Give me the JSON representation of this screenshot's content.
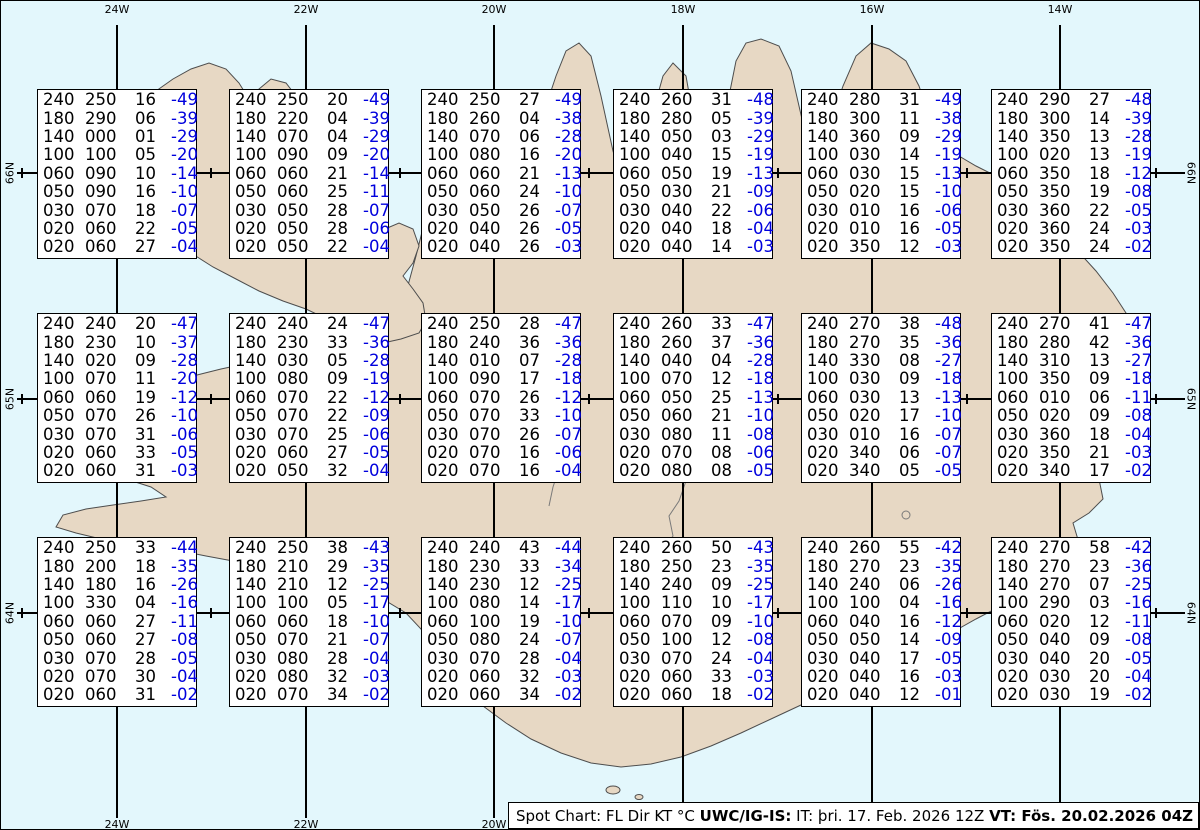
{
  "map": {
    "colors": {
      "water": "#e3f7fc",
      "land": "#e7d8c4",
      "coast": "#4d4d4d",
      "grid": "#000000",
      "temp_blue": "#0000dd"
    },
    "meridians": [
      {
        "label": "24W",
        "x": 116
      },
      {
        "label": "22W",
        "x": 305
      },
      {
        "label": "20W",
        "x": 493
      },
      {
        "label": "18W",
        "x": 682
      },
      {
        "label": "16W",
        "x": 871
      },
      {
        "label": "14W",
        "x": 1059
      }
    ],
    "parallels": [
      {
        "label": "66N",
        "y": 172
      },
      {
        "label": "65N",
        "y": 398
      },
      {
        "label": "64N",
        "y": 612
      }
    ]
  },
  "spots": {
    "legend_columns": [
      "FL",
      "Dir",
      "KT",
      "°C"
    ],
    "boxes": [
      {
        "lines": [
          [
            "240",
            "250",
            "16",
            "-49"
          ],
          [
            "180",
            "290",
            "06",
            "-39"
          ],
          [
            "140",
            "000",
            "01",
            "-29"
          ],
          [
            "100",
            "100",
            "05",
            "-20"
          ],
          [
            "060",
            "090",
            "10",
            "-14"
          ],
          [
            "050",
            "090",
            "16",
            "-10"
          ],
          [
            "030",
            "070",
            "18",
            "-07"
          ],
          [
            "020",
            "060",
            "22",
            "-05"
          ],
          [
            "020",
            "060",
            "27",
            "-04"
          ]
        ]
      },
      {
        "lines": [
          [
            "240",
            "250",
            "20",
            "-49"
          ],
          [
            "180",
            "220",
            "04",
            "-39"
          ],
          [
            "140",
            "070",
            "04",
            "-29"
          ],
          [
            "100",
            "090",
            "09",
            "-20"
          ],
          [
            "060",
            "060",
            "21",
            "-14"
          ],
          [
            "050",
            "060",
            "25",
            "-11"
          ],
          [
            "030",
            "050",
            "28",
            "-07"
          ],
          [
            "020",
            "050",
            "28",
            "-06"
          ],
          [
            "020",
            "050",
            "22",
            "-04"
          ]
        ]
      },
      {
        "lines": [
          [
            "240",
            "250",
            "27",
            "-49"
          ],
          [
            "180",
            "260",
            "04",
            "-38"
          ],
          [
            "140",
            "070",
            "06",
            "-28"
          ],
          [
            "100",
            "080",
            "16",
            "-20"
          ],
          [
            "060",
            "060",
            "21",
            "-13"
          ],
          [
            "050",
            "060",
            "24",
            "-10"
          ],
          [
            "030",
            "050",
            "26",
            "-07"
          ],
          [
            "020",
            "040",
            "26",
            "-05"
          ],
          [
            "020",
            "040",
            "26",
            "-03"
          ]
        ]
      },
      {
        "lines": [
          [
            "240",
            "260",
            "31",
            "-48"
          ],
          [
            "180",
            "280",
            "05",
            "-39"
          ],
          [
            "140",
            "050",
            "03",
            "-29"
          ],
          [
            "100",
            "040",
            "15",
            "-19"
          ],
          [
            "060",
            "050",
            "19",
            "-13"
          ],
          [
            "050",
            "030",
            "21",
            "-09"
          ],
          [
            "030",
            "040",
            "22",
            "-06"
          ],
          [
            "020",
            "040",
            "18",
            "-04"
          ],
          [
            "020",
            "040",
            "14",
            "-03"
          ]
        ]
      },
      {
        "lines": [
          [
            "240",
            "280",
            "31",
            "-49"
          ],
          [
            "180",
            "300",
            "11",
            "-38"
          ],
          [
            "140",
            "360",
            "09",
            "-29"
          ],
          [
            "100",
            "030",
            "14",
            "-19"
          ],
          [
            "060",
            "030",
            "15",
            "-13"
          ],
          [
            "050",
            "020",
            "15",
            "-10"
          ],
          [
            "030",
            "010",
            "16",
            "-06"
          ],
          [
            "020",
            "010",
            "16",
            "-05"
          ],
          [
            "020",
            "350",
            "12",
            "-03"
          ]
        ]
      },
      {
        "lines": [
          [
            "240",
            "290",
            "27",
            "-48"
          ],
          [
            "180",
            "300",
            "14",
            "-39"
          ],
          [
            "140",
            "350",
            "13",
            "-28"
          ],
          [
            "100",
            "020",
            "13",
            "-19"
          ],
          [
            "060",
            "350",
            "18",
            "-12"
          ],
          [
            "050",
            "350",
            "19",
            "-08"
          ],
          [
            "030",
            "360",
            "22",
            "-05"
          ],
          [
            "020",
            "360",
            "24",
            "-03"
          ],
          [
            "020",
            "350",
            "24",
            "-02"
          ]
        ]
      },
      {
        "lines": [
          [
            "240",
            "240",
            "20",
            "-47"
          ],
          [
            "180",
            "230",
            "10",
            "-37"
          ],
          [
            "140",
            "020",
            "09",
            "-28"
          ],
          [
            "100",
            "070",
            "11",
            "-20"
          ],
          [
            "060",
            "060",
            "19",
            "-12"
          ],
          [
            "050",
            "070",
            "26",
            "-10"
          ],
          [
            "030",
            "070",
            "31",
            "-06"
          ],
          [
            "020",
            "060",
            "33",
            "-05"
          ],
          [
            "020",
            "060",
            "31",
            "-03"
          ]
        ]
      },
      {
        "lines": [
          [
            "240",
            "240",
            "24",
            "-47"
          ],
          [
            "180",
            "230",
            "33",
            "-36"
          ],
          [
            "140",
            "030",
            "05",
            "-28"
          ],
          [
            "100",
            "080",
            "09",
            "-19"
          ],
          [
            "060",
            "070",
            "22",
            "-12"
          ],
          [
            "050",
            "070",
            "22",
            "-09"
          ],
          [
            "030",
            "070",
            "25",
            "-06"
          ],
          [
            "020",
            "060",
            "27",
            "-05"
          ],
          [
            "020",
            "050",
            "32",
            "-04"
          ]
        ]
      },
      {
        "lines": [
          [
            "240",
            "250",
            "28",
            "-47"
          ],
          [
            "180",
            "240",
            "36",
            "-36"
          ],
          [
            "140",
            "010",
            "07",
            "-28"
          ],
          [
            "100",
            "090",
            "17",
            "-18"
          ],
          [
            "060",
            "070",
            "26",
            "-12"
          ],
          [
            "050",
            "070",
            "33",
            "-10"
          ],
          [
            "030",
            "070",
            "26",
            "-07"
          ],
          [
            "020",
            "070",
            "16",
            "-06"
          ],
          [
            "020",
            "070",
            "16",
            "-04"
          ]
        ]
      },
      {
        "lines": [
          [
            "240",
            "260",
            "33",
            "-47"
          ],
          [
            "180",
            "260",
            "37",
            "-36"
          ],
          [
            "140",
            "040",
            "04",
            "-28"
          ],
          [
            "100",
            "070",
            "12",
            "-18"
          ],
          [
            "060",
            "050",
            "25",
            "-13"
          ],
          [
            "050",
            "060",
            "21",
            "-10"
          ],
          [
            "030",
            "080",
            "11",
            "-08"
          ],
          [
            "020",
            "070",
            "08",
            "-06"
          ],
          [
            "020",
            "080",
            "08",
            "-05"
          ]
        ]
      },
      {
        "lines": [
          [
            "240",
            "270",
            "38",
            "-48"
          ],
          [
            "180",
            "270",
            "35",
            "-36"
          ],
          [
            "140",
            "330",
            "08",
            "-27"
          ],
          [
            "100",
            "030",
            "09",
            "-18"
          ],
          [
            "060",
            "030",
            "13",
            "-13"
          ],
          [
            "050",
            "020",
            "17",
            "-10"
          ],
          [
            "030",
            "010",
            "16",
            "-07"
          ],
          [
            "020",
            "340",
            "06",
            "-07"
          ],
          [
            "020",
            "340",
            "05",
            "-05"
          ]
        ]
      },
      {
        "lines": [
          [
            "240",
            "270",
            "41",
            "-47"
          ],
          [
            "180",
            "280",
            "42",
            "-36"
          ],
          [
            "140",
            "310",
            "13",
            "-27"
          ],
          [
            "100",
            "350",
            "09",
            "-18"
          ],
          [
            "060",
            "010",
            "06",
            "-11"
          ],
          [
            "050",
            "020",
            "09",
            "-08"
          ],
          [
            "030",
            "360",
            "18",
            "-04"
          ],
          [
            "020",
            "350",
            "21",
            "-03"
          ],
          [
            "020",
            "340",
            "17",
            "-02"
          ]
        ]
      },
      {
        "lines": [
          [
            "240",
            "250",
            "33",
            "-44"
          ],
          [
            "180",
            "200",
            "18",
            "-35"
          ],
          [
            "140",
            "180",
            "16",
            "-26"
          ],
          [
            "100",
            "330",
            "04",
            "-16"
          ],
          [
            "060",
            "060",
            "27",
            "-11"
          ],
          [
            "050",
            "060",
            "27",
            "-08"
          ],
          [
            "030",
            "070",
            "28",
            "-05"
          ],
          [
            "020",
            "070",
            "30",
            "-04"
          ],
          [
            "020",
            "060",
            "31",
            "-02"
          ]
        ]
      },
      {
        "lines": [
          [
            "240",
            "250",
            "38",
            "-43"
          ],
          [
            "180",
            "210",
            "29",
            "-35"
          ],
          [
            "140",
            "210",
            "12",
            "-25"
          ],
          [
            "100",
            "100",
            "05",
            "-17"
          ],
          [
            "060",
            "060",
            "18",
            "-10"
          ],
          [
            "050",
            "070",
            "21",
            "-07"
          ],
          [
            "030",
            "080",
            "28",
            "-04"
          ],
          [
            "020",
            "080",
            "32",
            "-03"
          ],
          [
            "020",
            "070",
            "34",
            "-02"
          ]
        ]
      },
      {
        "lines": [
          [
            "240",
            "240",
            "43",
            "-44"
          ],
          [
            "180",
            "230",
            "33",
            "-34"
          ],
          [
            "140",
            "230",
            "12",
            "-25"
          ],
          [
            "100",
            "080",
            "14",
            "-17"
          ],
          [
            "060",
            "100",
            "19",
            "-10"
          ],
          [
            "050",
            "080",
            "24",
            "-07"
          ],
          [
            "030",
            "070",
            "28",
            "-04"
          ],
          [
            "020",
            "060",
            "32",
            "-03"
          ],
          [
            "020",
            "060",
            "34",
            "-02"
          ]
        ]
      },
      {
        "lines": [
          [
            "240",
            "260",
            "50",
            "-43"
          ],
          [
            "180",
            "250",
            "23",
            "-35"
          ],
          [
            "140",
            "240",
            "09",
            "-25"
          ],
          [
            "100",
            "110",
            "10",
            "-17"
          ],
          [
            "060",
            "070",
            "09",
            "-10"
          ],
          [
            "050",
            "100",
            "12",
            "-08"
          ],
          [
            "030",
            "070",
            "24",
            "-04"
          ],
          [
            "020",
            "060",
            "33",
            "-03"
          ],
          [
            "020",
            "060",
            "18",
            "-02"
          ]
        ]
      },
      {
        "lines": [
          [
            "240",
            "260",
            "55",
            "-42"
          ],
          [
            "180",
            "270",
            "23",
            "-35"
          ],
          [
            "140",
            "240",
            "06",
            "-26"
          ],
          [
            "100",
            "100",
            "04",
            "-16"
          ],
          [
            "060",
            "040",
            "16",
            "-12"
          ],
          [
            "050",
            "050",
            "14",
            "-09"
          ],
          [
            "030",
            "040",
            "17",
            "-05"
          ],
          [
            "020",
            "040",
            "16",
            "-03"
          ],
          [
            "020",
            "040",
            "12",
            "-01"
          ]
        ]
      },
      {
        "lines": [
          [
            "240",
            "270",
            "58",
            "-42"
          ],
          [
            "180",
            "270",
            "23",
            "-36"
          ],
          [
            "140",
            "270",
            "07",
            "-25"
          ],
          [
            "100",
            "290",
            "03",
            "-16"
          ],
          [
            "060",
            "020",
            "12",
            "-11"
          ],
          [
            "050",
            "040",
            "09",
            "-08"
          ],
          [
            "030",
            "040",
            "20",
            "-05"
          ],
          [
            "020",
            "030",
            "20",
            "-04"
          ],
          [
            "020",
            "030",
            "19",
            "-02"
          ]
        ]
      }
    ]
  },
  "footer": {
    "segments": [
      {
        "text": "Spot Chart: FL Dir KT °C ",
        "bold": false
      },
      {
        "text": "UWC/IG-IS:",
        "bold": true
      },
      {
        "text": " IT: þri. 17. Feb. 2026 12Z ",
        "bold": false
      },
      {
        "text": "VT: Fös. 20.02.2026 04Z",
        "bold": true
      },
      {
        "text": " (+64 h)",
        "bold": false
      }
    ]
  }
}
